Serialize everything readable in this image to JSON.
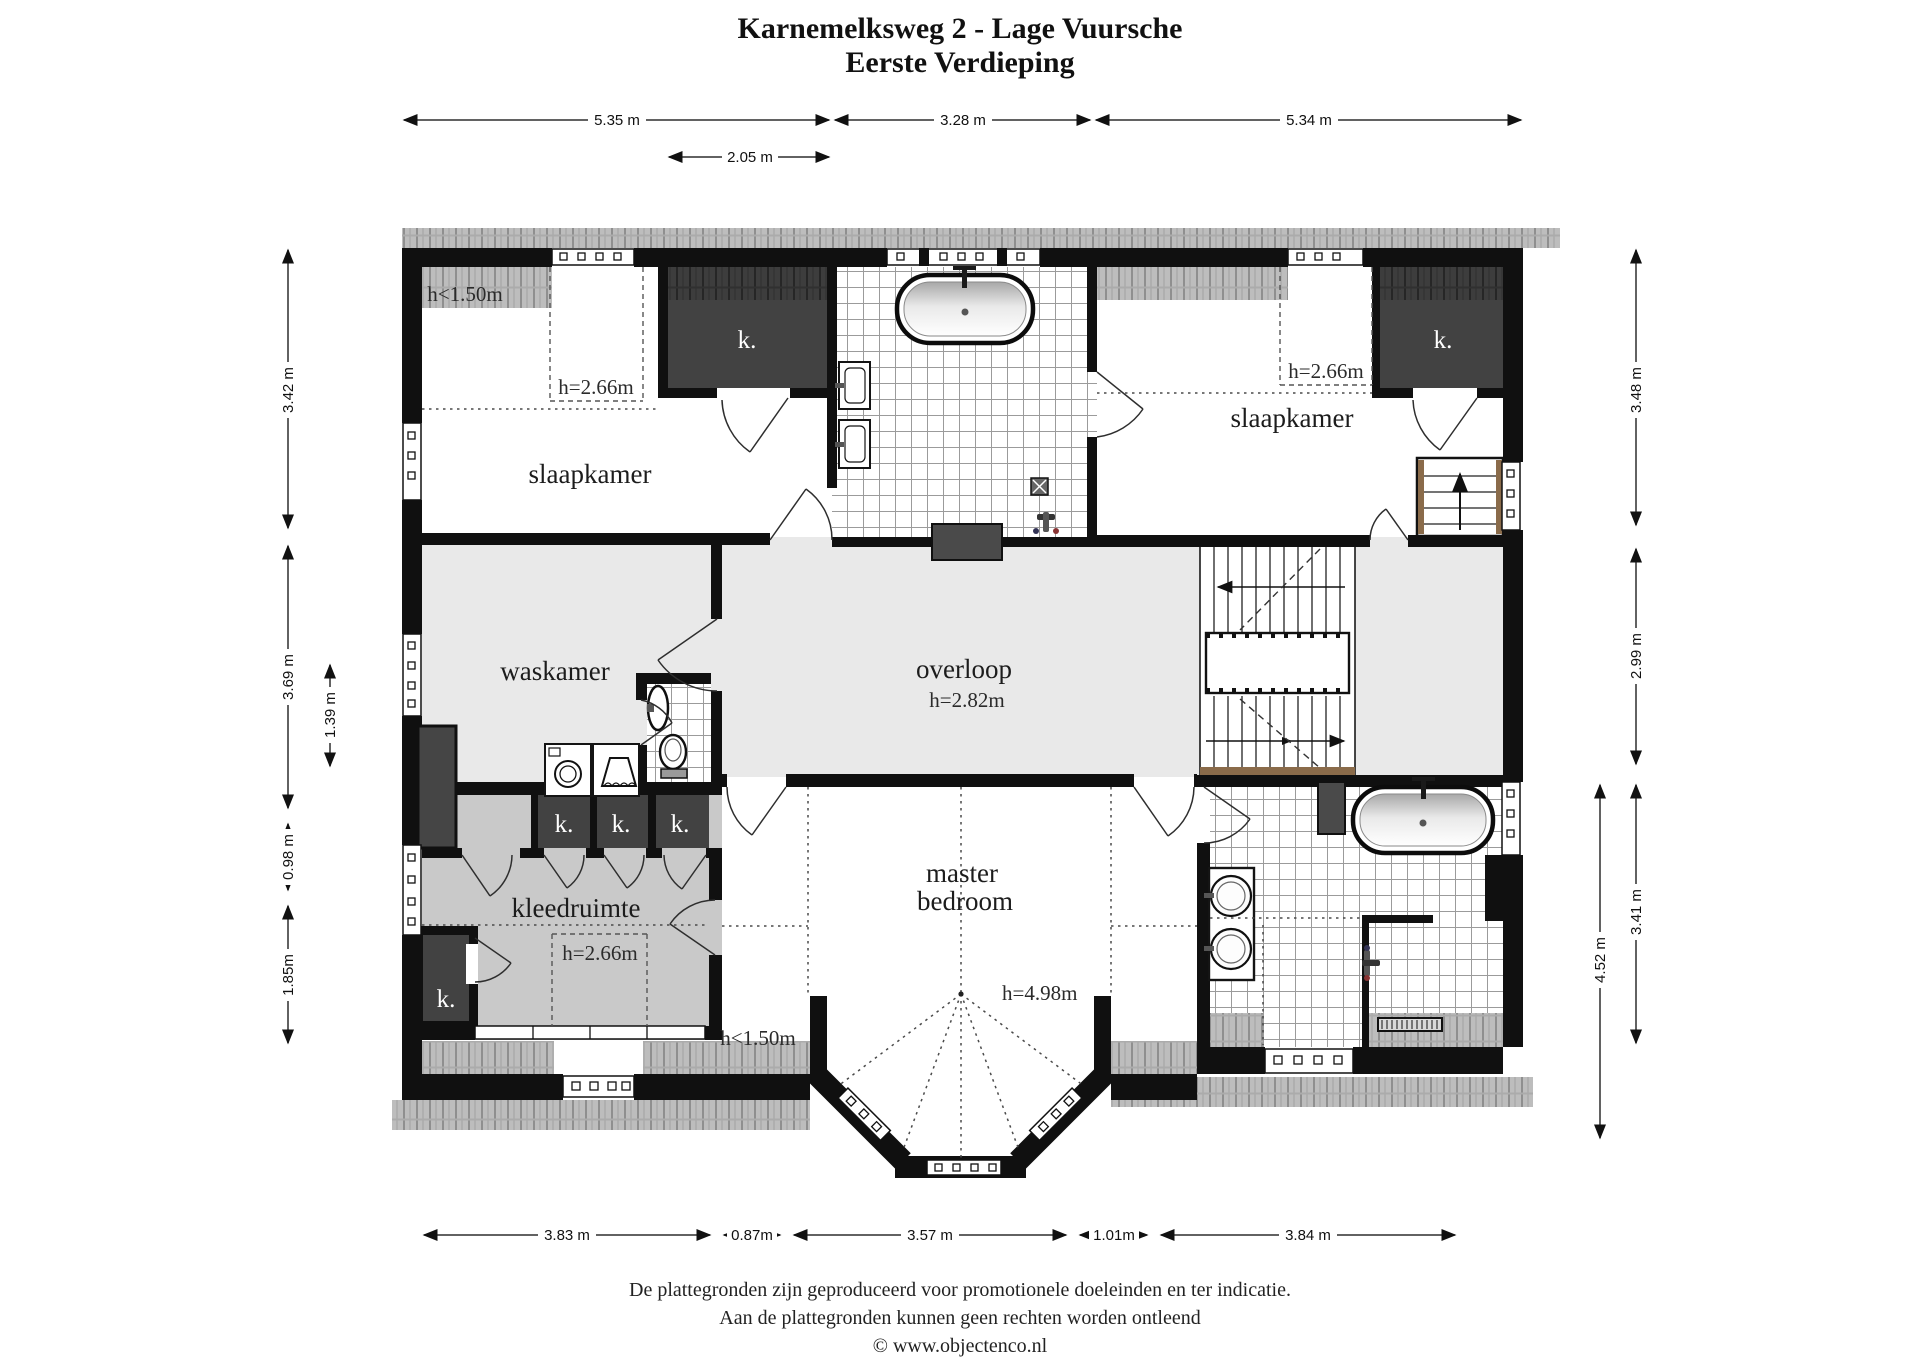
{
  "title": {
    "line1": "Karnemelksweg 2 - Lage Vuursche",
    "line2": "Eerste Verdieping"
  },
  "rooms": {
    "slaapkamer_left": "slaapkamer",
    "slaapkamer_right": "slaapkamer",
    "waskamer": "waskamer",
    "overloop": "overloop",
    "kleedruimte": "kleedruimte",
    "master_line1": "master",
    "master_line2": "bedroom",
    "closet": "k."
  },
  "heights": {
    "under150": "h<1.50m",
    "h266": "h=2.66m",
    "h282": "h=2.82m",
    "h498": "h=4.98m"
  },
  "dimensions": {
    "top": [
      "5.35 m",
      "3.28 m",
      "5.34 m"
    ],
    "top_inner": "2.05 m",
    "left": [
      "3.42 m",
      "3.69 m",
      "0.98 m",
      "1.85m"
    ],
    "left_inner": "1.39 m",
    "right": [
      "3.48 m",
      "2.99 m",
      "3.41 m"
    ],
    "right_inner": "4.52 m",
    "bottom": [
      "3.83 m",
      "0.87m",
      "3.57 m",
      "1.01m",
      "3.84 m"
    ]
  },
  "footer": {
    "line1": "De plattegronden zijn geproduceerd voor promotionele doeleinden en ter indicatie.",
    "line2": "Aan de plattegronden kunnen geen rechten worden ontleend",
    "line3": "© www.objectenco.nl"
  }
}
